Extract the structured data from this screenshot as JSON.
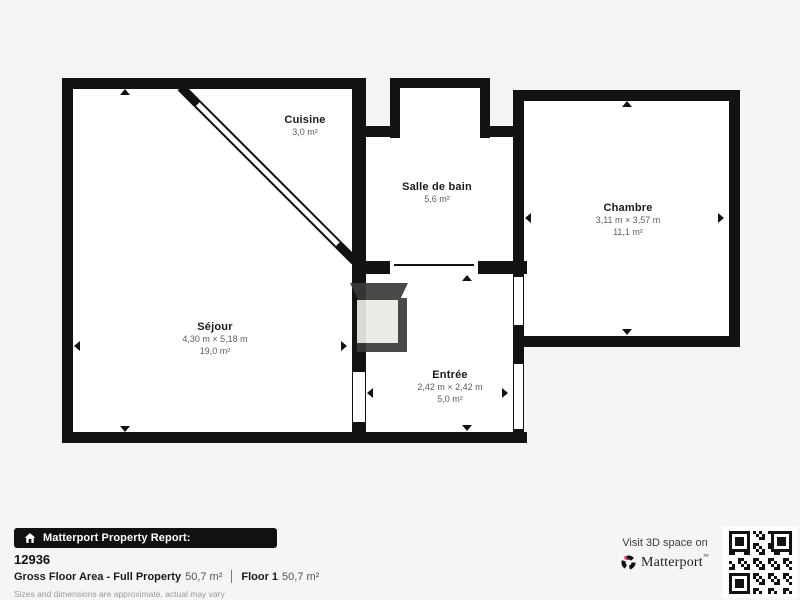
{
  "colors": {
    "wall": "#121212",
    "background": "#f6f5f3",
    "room": "#ffffff",
    "accent_pink": "#e8336d",
    "label": "#1b1b1b",
    "dim_text": "#5d5d5d"
  },
  "plan": {
    "rooms": {
      "cuisine": {
        "name": "Cuisine",
        "area": "3,0 m²"
      },
      "salle_de_bain": {
        "name": "Salle de bain",
        "area": "5,6 m²"
      },
      "chambre": {
        "name": "Chambre",
        "dimensions": "3,11 m × 3,57 m",
        "area": "11,1 m²"
      },
      "sejour": {
        "name": "Séjour",
        "dimensions": "4,30 m × 5,18 m",
        "area": "19,0 m²"
      },
      "entree": {
        "name": "Entrée",
        "dimensions": "2,42 m × 2,42 m",
        "area": "5,0 m²"
      }
    }
  },
  "footer": {
    "badge_label": "Matterport Property Report:",
    "property_id": "12936",
    "gross_floor_label": "Gross Floor Area - Full Property",
    "gross_floor_value": "50,7 m²",
    "floor_label": "Floor 1",
    "floor_value": "50,7 m²",
    "disclaimer": "Sizes and dimensions are approximate, actual may vary"
  },
  "cta": {
    "visit_text": "Visit 3D space on",
    "brand": "Matterport",
    "brand_mark": "™"
  }
}
